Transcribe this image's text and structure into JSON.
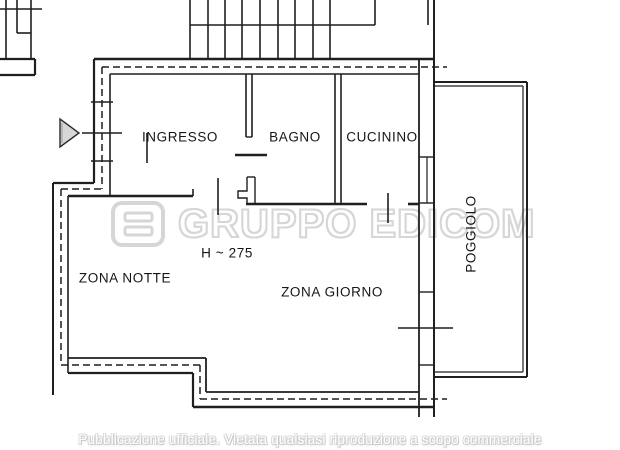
{
  "labels": {
    "ingresso": "INGRESSO",
    "bagno": "BAGNO",
    "cucinino": "CUCININO",
    "zona_notte": "ZONA NOTTE",
    "zona_giorno": "ZONA GIORNO",
    "poggiolo": "POGGIOLO",
    "height_note": "H ~ 275"
  },
  "watermark": {
    "logo_icon": "edicom-logo",
    "text": "GRUPPO EDICOM"
  },
  "footer": {
    "text": "Pubblicazione ufficiale. Vietata qualsiasi riproduzione a scopo commerciale"
  },
  "colors": {
    "line": "#1f1f1f",
    "watermark_gray": "#d6d6d6",
    "caption_outline": "#c9c9c9",
    "background": "#ffffff",
    "arrow_fill": "#d7d7d7"
  }
}
